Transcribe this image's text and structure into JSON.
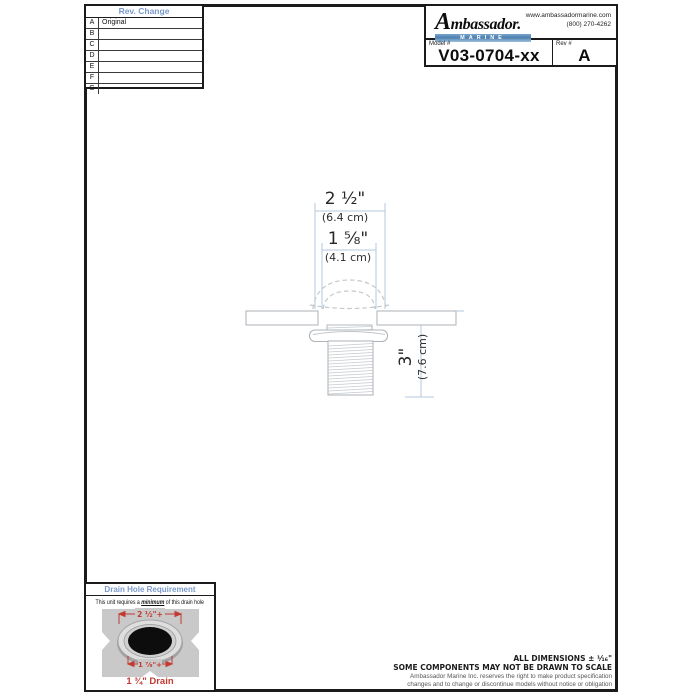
{
  "rev_table": {
    "title": "Rev. Change",
    "rows": [
      {
        "letter": "A",
        "change": "Original"
      },
      {
        "letter": "B",
        "change": ""
      },
      {
        "letter": "C",
        "change": ""
      },
      {
        "letter": "D",
        "change": ""
      },
      {
        "letter": "E",
        "change": ""
      },
      {
        "letter": "F",
        "change": ""
      },
      {
        "letter": "G",
        "change": ""
      }
    ]
  },
  "title_block": {
    "brand": "Ambassador.",
    "brand_sub": "MARINE",
    "website": "www.ambassadormarine.com",
    "phone": "(800) 270-4262",
    "model_label": "Model #",
    "model_value": "V03-0704-xx",
    "rev_label": "Rev #",
    "rev_value": "A"
  },
  "drawing": {
    "dim_top_in": "2 ¹⁄₂\"",
    "dim_top_cm": "(6.4 cm)",
    "dim_mid_in": "1 ⁵⁄₈\"",
    "dim_mid_cm": "(4.1 cm)",
    "dim_len_in": "3\"",
    "dim_len_cm": "(7.6 cm)"
  },
  "drain_box": {
    "title": "Drain Hole Requirement",
    "note_prefix": "This unit requires a ",
    "note_emphasis": "minimum",
    "note_suffix": " of this drain hole",
    "dim_top": "2 ½\"+",
    "dim_bottom": "1 ⅞\"+",
    "caption": "1 ¾\" Drain"
  },
  "footer": {
    "line1": "ALL DIMENSIONS ± ¹⁄₁₆\"",
    "line2": "SOME COMPONENTS MAY NOT BE DRAWN TO SCALE",
    "line3": "Ambassador Marine Inc. reserves the right to make product specification",
    "line4": "changes and to change or discontinue models without notice or obligation"
  },
  "colors": {
    "accent_blue": "#7b9aca",
    "dim_line_blue": "#b5cade",
    "drawing_gray": "#b3b9bd",
    "red": "#c23b32"
  }
}
